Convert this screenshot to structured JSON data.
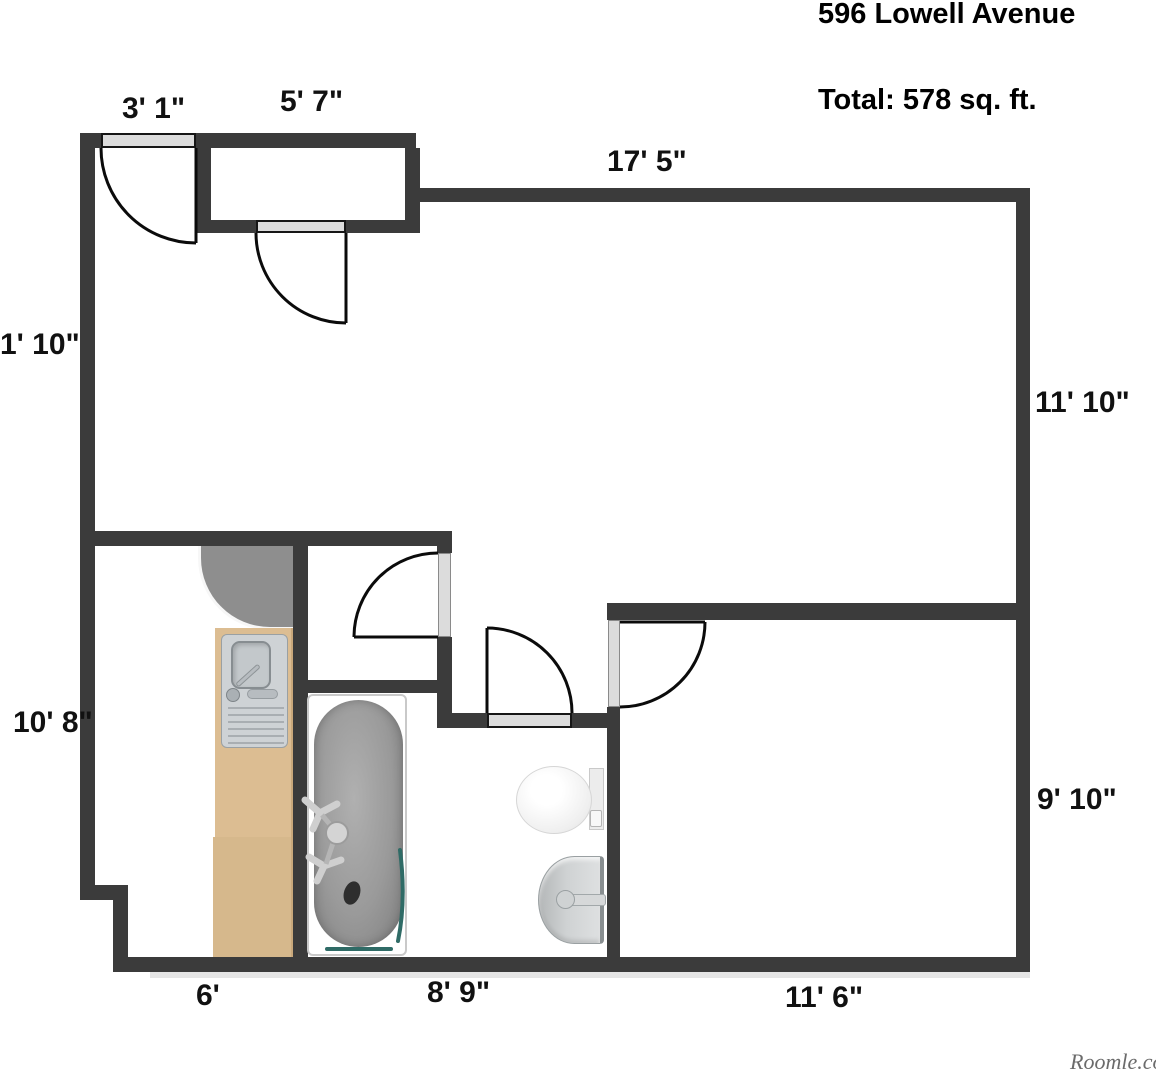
{
  "header": {
    "address": "596 Lowell Avenue",
    "total": "Total: 578 sq. ft."
  },
  "dimensions": {
    "entry_door": "3' 1\"",
    "closet_width": "5' 7\"",
    "living_top": "17' 5\"",
    "left_upper_clipped": "1'  10\"",
    "living_right": "11' 10\"",
    "kitchen_left": "10' 8\"",
    "bedroom_right": "9' 10\"",
    "kitchen_bottom": "6'",
    "bathroom_bottom": "8' 9\"",
    "bedroom_bottom": "11' 6\""
  },
  "watermark": "Roomle.com",
  "fixtures": [
    "entry-door",
    "closet-door",
    "hall-closet-door",
    "bathroom-door",
    "bedroom-door",
    "kitchen-counter",
    "kitchen-sink",
    "bathtub",
    "toilet",
    "bathroom-sink"
  ],
  "colors": {
    "wall": "#3b3b3b",
    "door_sill": "#dcdcdc",
    "counter_gray": "#8e8e8e",
    "counter_wood": "#dabb8f",
    "tub_gray": "#9b9b9b",
    "accent_teal": "#2f6b66",
    "text": "#111111"
  }
}
